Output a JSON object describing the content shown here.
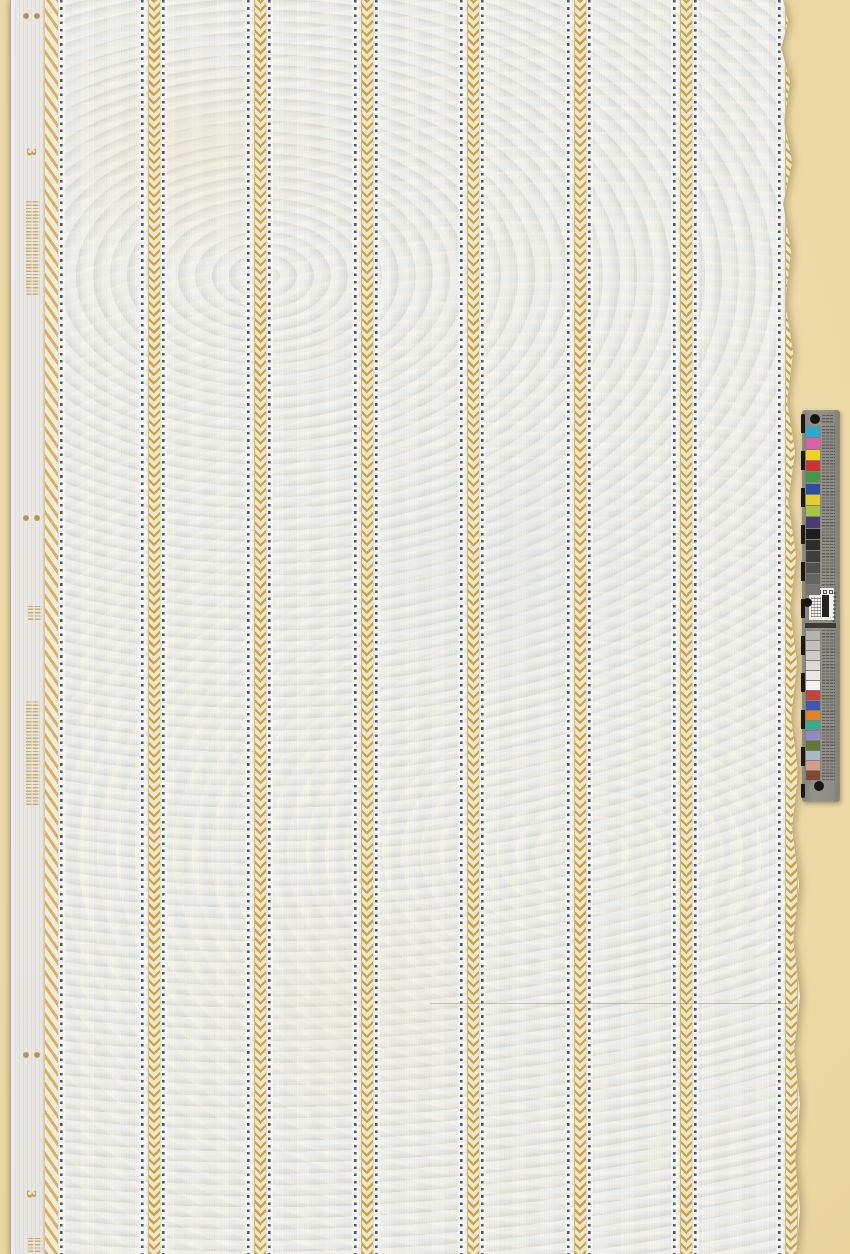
{
  "photo": {
    "description_labels": {
      "selvedge_numeral": "3"
    },
    "backdrop_color": "#ebd7a2",
    "paper": {
      "base_color": "#ede8da",
      "selvedge_color": "#eae8e3",
      "gold_color": "#c9a24a",
      "dot_color": "#475a7c",
      "stripe_unit_centers": [
        143,
        249.5,
        356,
        462.5,
        569,
        675.5
      ],
      "partial_edge_unit": {
        "center": 780,
        "left_dot_only": true
      },
      "extra_dotline_x": 51,
      "seam": {
        "y": 1003,
        "x1": 420,
        "x2": 783
      },
      "selvedge_numerals": [
        {
          "label": "3",
          "x": 16,
          "y": 146
        },
        {
          "label": "3",
          "x": 16,
          "y": 1188
        }
      ],
      "inscriptions": [
        {
          "x": 15,
          "y": 200,
          "h": 95
        },
        {
          "x": 17,
          "y": 606,
          "h": 14
        },
        {
          "x": 15,
          "y": 700,
          "h": 105
        },
        {
          "x": 17,
          "y": 1238,
          "h": 14
        }
      ],
      "pinhole_pair_rows": [
        13,
        515,
        1052
      ],
      "pinhole_xs": [
        12,
        23
      ]
    },
    "calibration_target": {
      "body_color": "#8e8c85",
      "top_fiducial": {
        "cx": 13,
        "cy": 9,
        "d": 10
      },
      "mid_fiducial": {
        "cx": 5.5,
        "cy": 192,
        "d": 9
      },
      "bottom_fiducial": {
        "cx": 17,
        "cy": 376,
        "d": 10
      },
      "upper_patches": [
        "#2aaad2",
        "#dc60a6",
        "#eed224",
        "#c8342f",
        "#3f9a47",
        "#2b4fa4",
        "#e6cd2d",
        "#a6c643",
        "#4a3a72"
      ],
      "upper_grays": [
        "#1c1c1b",
        "#2d2d2b",
        "#3e3e3c",
        "#50504e",
        "#636361",
        "#767572"
      ],
      "upper_stack": {
        "y0": 17,
        "step": 11.3,
        "h": 10.3
      },
      "lower_grays": [
        "#b5b3ae",
        "#c2c0bb",
        "#cfcdc8",
        "#dcdad5",
        "#e9e7e2",
        "#f5f4f0"
      ],
      "lower_grays_stack": {
        "y0": 221,
        "step": 10,
        "h": 9
      },
      "lower_patches": [
        "#c2443a",
        "#3b59ae",
        "#df8526",
        "#3aa98e",
        "#908ac0",
        "#5e7a35",
        "#a9b8c6",
        "#d79b88",
        "#7c4b33"
      ],
      "lower_stack": {
        "y0": 281,
        "step": 10,
        "h": 9
      },
      "microtext_columns": [
        {
          "x": 20,
          "y": 16,
          "w": 13,
          "h": 160
        },
        {
          "x": 20,
          "y": 220,
          "w": 13,
          "h": 152
        },
        {
          "x": 20,
          "y": 5,
          "w": 11,
          "h": 8
        }
      ]
    }
  }
}
